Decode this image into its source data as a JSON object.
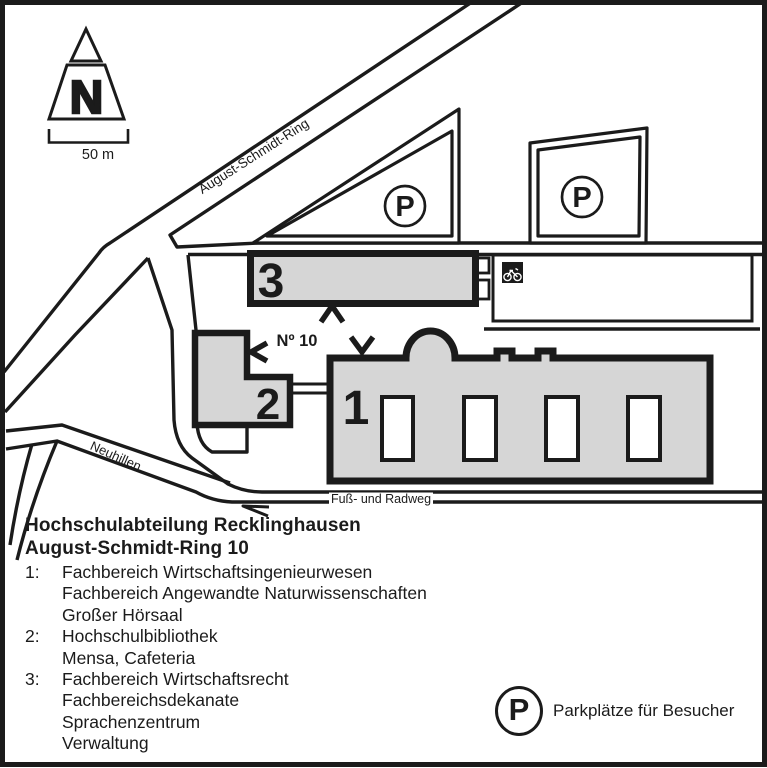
{
  "map": {
    "north_label": "N",
    "scale_label": "50 m",
    "streets": {
      "august": "August-Schmidt-Ring",
      "neuhillen": "Neuhillen",
      "radweg": "Fuß- und Radweg"
    },
    "buildings": {
      "b1": "1",
      "b2": "2",
      "b3": "3"
    },
    "entrance_label": "Nº 10",
    "parking_letter": "P"
  },
  "legend": {
    "title": "Hochschulabteilung Recklinghausen",
    "subtitle": "August-Schmidt-Ring 10",
    "entries": [
      {
        "num": "1:",
        "lines": [
          "Fachbereich Wirtschaftsingenieurwesen",
          "Fachbereich Angewandte Naturwissenschaften",
          "Großer Hörsaal"
        ]
      },
      {
        "num": "2:",
        "lines": [
          "Hochschulbibliothek",
          "Mensa, Cafeteria"
        ]
      },
      {
        "num": "3:",
        "lines": [
          "Fachbereich Wirtschaftsrecht",
          "Fachbereichsdekanate",
          "Sprachenzentrum",
          "Verwaltung"
        ]
      }
    ],
    "parking": {
      "letter": "P",
      "label": "Parkplätze für Besucher"
    }
  },
  "colors": {
    "ink": "#1b1b1b",
    "building_fill": "#d6d6d6",
    "bg": "#ffffff"
  }
}
